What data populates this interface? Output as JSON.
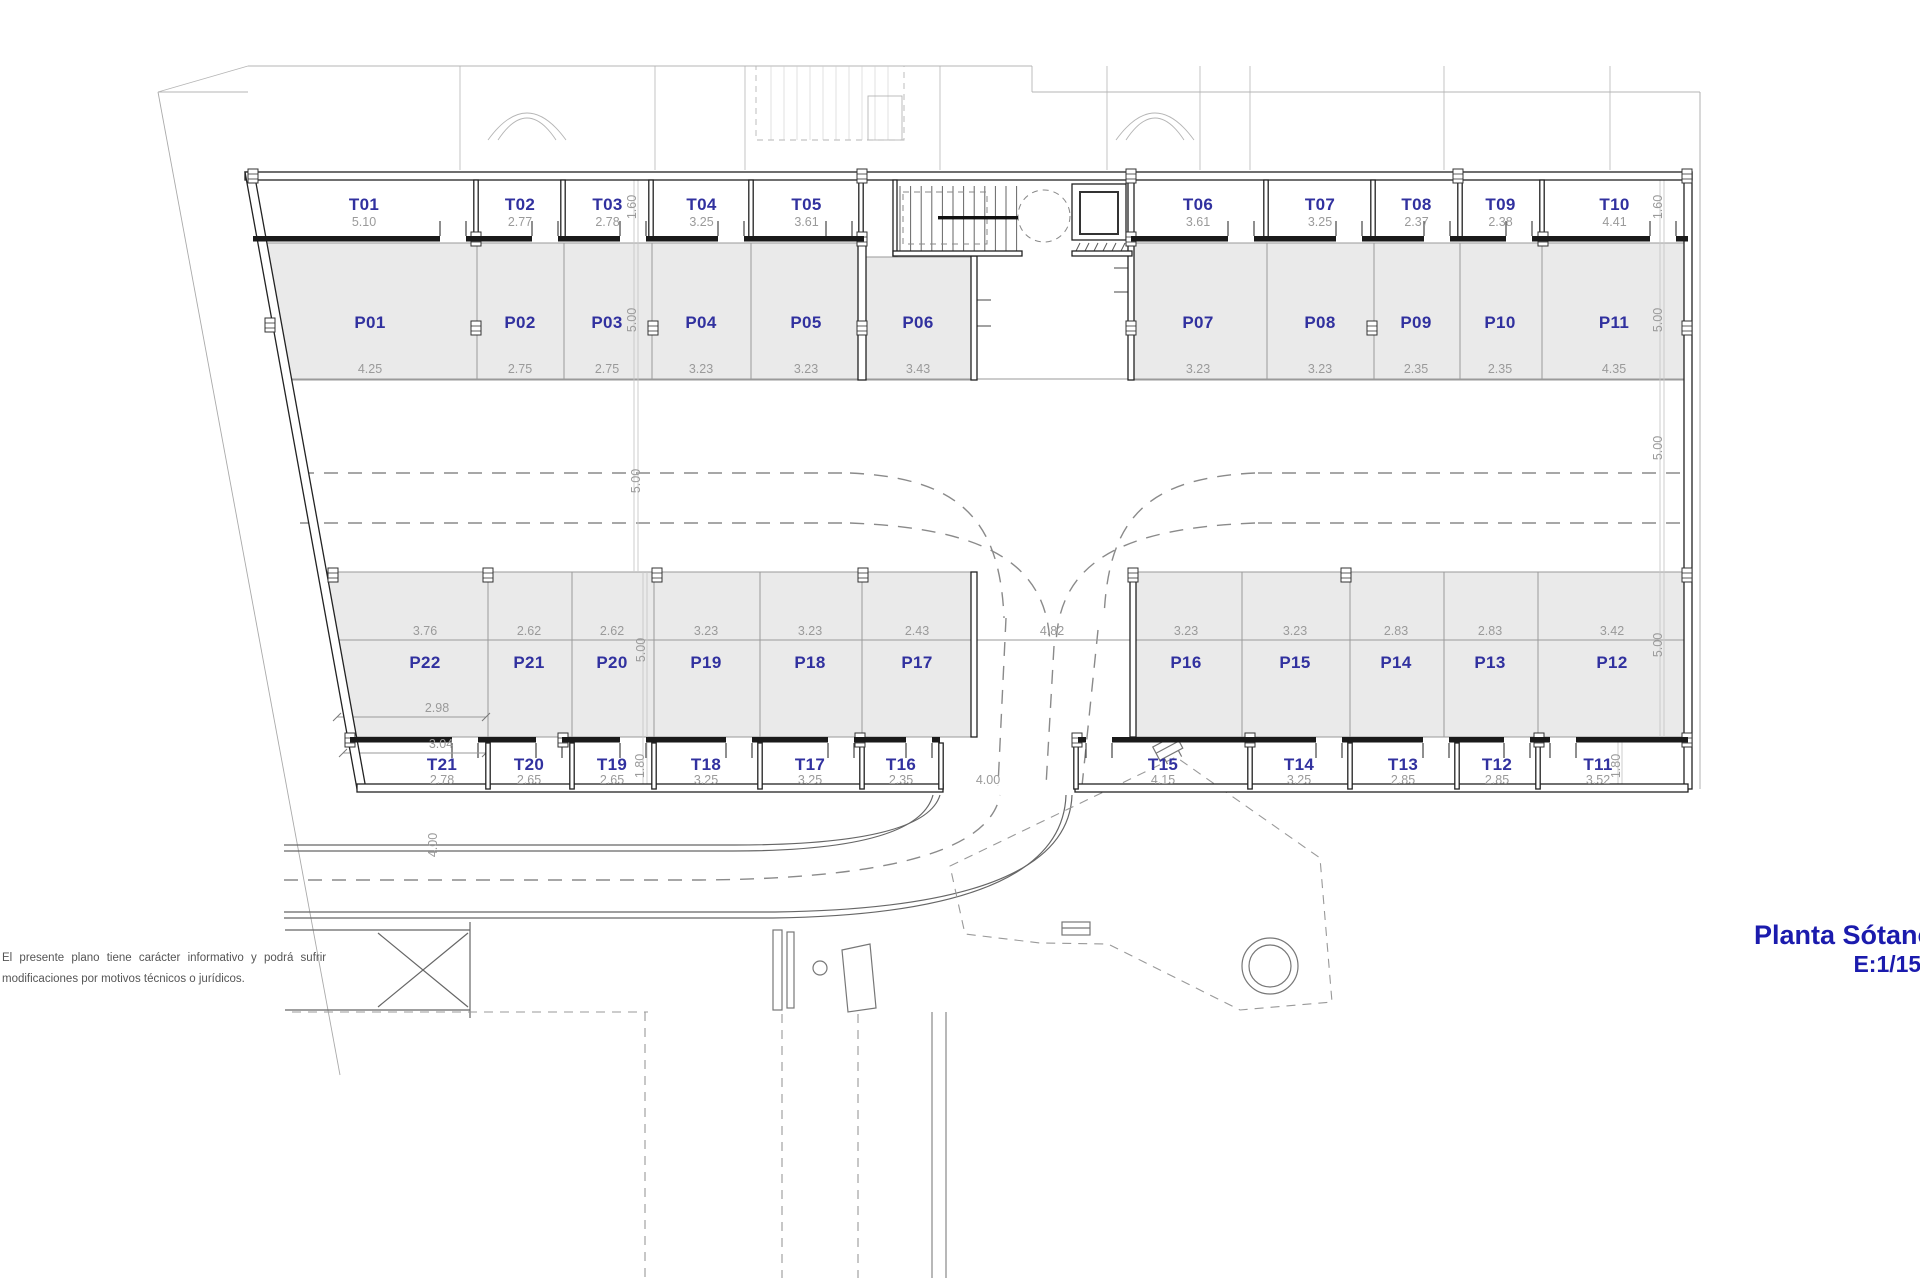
{
  "document": {
    "title": "Planta Sótano",
    "scale": "E:1/150",
    "disclaimer_line1": "El presente plano tiene carácter informativo y podrá sufrir",
    "disclaimer_line2": "modificaciones por motivos técnicos o jurídicos."
  },
  "colors": {
    "room_label": "#31319f",
    "dim_text": "#9a9a9a",
    "wall": "#1f1f1f",
    "parking_fill": "#eaeaea",
    "title": "#1b1bad"
  },
  "plan": {
    "storage_top": [
      {
        "id": "T01",
        "width_m": "5.10"
      },
      {
        "id": "T02",
        "width_m": "2.77"
      },
      {
        "id": "T03",
        "width_m": "2.78"
      },
      {
        "id": "T04",
        "width_m": "3.25"
      },
      {
        "id": "T05",
        "width_m": "3.61"
      },
      {
        "id": "T06",
        "width_m": "3.61"
      },
      {
        "id": "T07",
        "width_m": "3.25"
      },
      {
        "id": "T08",
        "width_m": "2.37"
      },
      {
        "id": "T09",
        "width_m": "2.38"
      },
      {
        "id": "T10",
        "width_m": "4.41"
      }
    ],
    "parking_top": [
      {
        "id": "P01",
        "width_m": "4.25"
      },
      {
        "id": "P02",
        "width_m": "2.75"
      },
      {
        "id": "P03",
        "width_m": "2.75"
      },
      {
        "id": "P04",
        "width_m": "3.23"
      },
      {
        "id": "P05",
        "width_m": "3.23"
      },
      {
        "id": "P06",
        "width_m": "3.43"
      },
      {
        "id": "P07",
        "width_m": "3.23"
      },
      {
        "id": "P08",
        "width_m": "3.23"
      },
      {
        "id": "P09",
        "width_m": "2.35"
      },
      {
        "id": "P10",
        "width_m": "2.35"
      },
      {
        "id": "P11",
        "width_m": "4.35"
      }
    ],
    "parking_bottom": [
      {
        "id": "P22",
        "width_m": "3.76"
      },
      {
        "id": "P21",
        "width_m": "2.62"
      },
      {
        "id": "P20",
        "width_m": "2.62"
      },
      {
        "id": "P19",
        "width_m": "3.23"
      },
      {
        "id": "P18",
        "width_m": "3.23"
      },
      {
        "id": "P17",
        "width_m": "2.43"
      },
      {
        "id": "P16",
        "width_m": "3.23"
      },
      {
        "id": "P15",
        "width_m": "3.23"
      },
      {
        "id": "P14",
        "width_m": "2.83"
      },
      {
        "id": "P13",
        "width_m": "2.83"
      },
      {
        "id": "P12",
        "width_m": "3.42"
      }
    ],
    "storage_bottom": [
      {
        "id": "T21",
        "width_m": "2.78"
      },
      {
        "id": "T20",
        "width_m": "2.65"
      },
      {
        "id": "T19",
        "width_m": "2.65"
      },
      {
        "id": "T18",
        "width_m": "3.25"
      },
      {
        "id": "T17",
        "width_m": "3.25"
      },
      {
        "id": "T16",
        "width_m": "2.35"
      },
      {
        "id": "T15",
        "width_m": "4.15"
      },
      {
        "id": "T14",
        "width_m": "3.25"
      },
      {
        "id": "T13",
        "width_m": "2.85"
      },
      {
        "id": "T12",
        "width_m": "2.85"
      },
      {
        "id": "T11",
        "width_m": "3.52"
      }
    ],
    "left_dim_chain": [
      "1.60",
      "5.00",
      "5.00",
      "5.00",
      "1.80"
    ],
    "right_dim_chain": [
      "1.60",
      "5.00",
      "5.00",
      "5.00",
      "1.80"
    ],
    "lane_dim_top": "4.82",
    "lane_dim_bottom": "4.00",
    "ramp_dim": "4.00",
    "p22_extra_dims": [
      "2.98",
      "3.04"
    ]
  }
}
